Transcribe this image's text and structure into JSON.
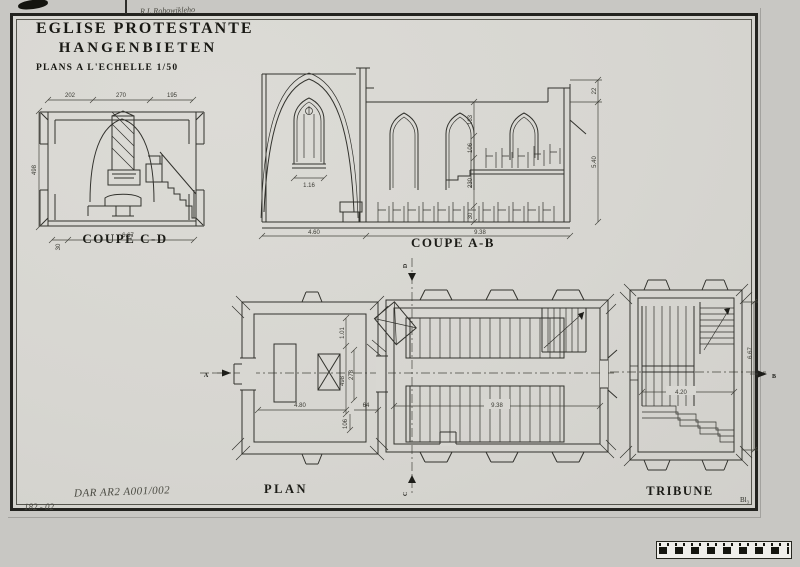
{
  "title_block": {
    "line1": "EGLISE PROTESTANTE",
    "line2": "HANGENBIETEN",
    "line3": "PLANS A L'ECHELLE 1/50"
  },
  "handwriting": {
    "top_note": "R.L.Rohowikleho",
    "catalog_number": "DAR AR2 A001/002",
    "corner_number": "182 - 02"
  },
  "sheet_mark": "Bl₃",
  "sections": {
    "coupe_cd": {
      "label": "COUPE C-D",
      "dim_top_left": "202",
      "dim_top_center": "270",
      "dim_top_right": "195",
      "dim_height": "498",
      "dim_width": "6.67",
      "dim_base": "30"
    },
    "coupe_ab": {
      "label": "COUPE A-B",
      "dim_window": "1.16",
      "dim_left_width": "4.60",
      "dim_right_width": "9.38",
      "dim_v1": "163",
      "dim_v2": "106",
      "dim_v3": "230",
      "dim_v4": "30",
      "dim_parapet": "22",
      "dim_right_height": "5.40"
    },
    "plan": {
      "label": "PLAN",
      "marker_a": "A",
      "marker_c": "C",
      "marker_d": "D",
      "dim_chancel": "4.80",
      "dim_64": "64",
      "dim_106": "106",
      "dim_101": "1.01",
      "dim_498": "498",
      "dim_278": "278",
      "dim_nave": "9.38"
    },
    "tribune": {
      "label": "TRIBUNE",
      "marker_b": "B",
      "dim_width": "4.20",
      "dim_height": "6.67"
    }
  }
}
